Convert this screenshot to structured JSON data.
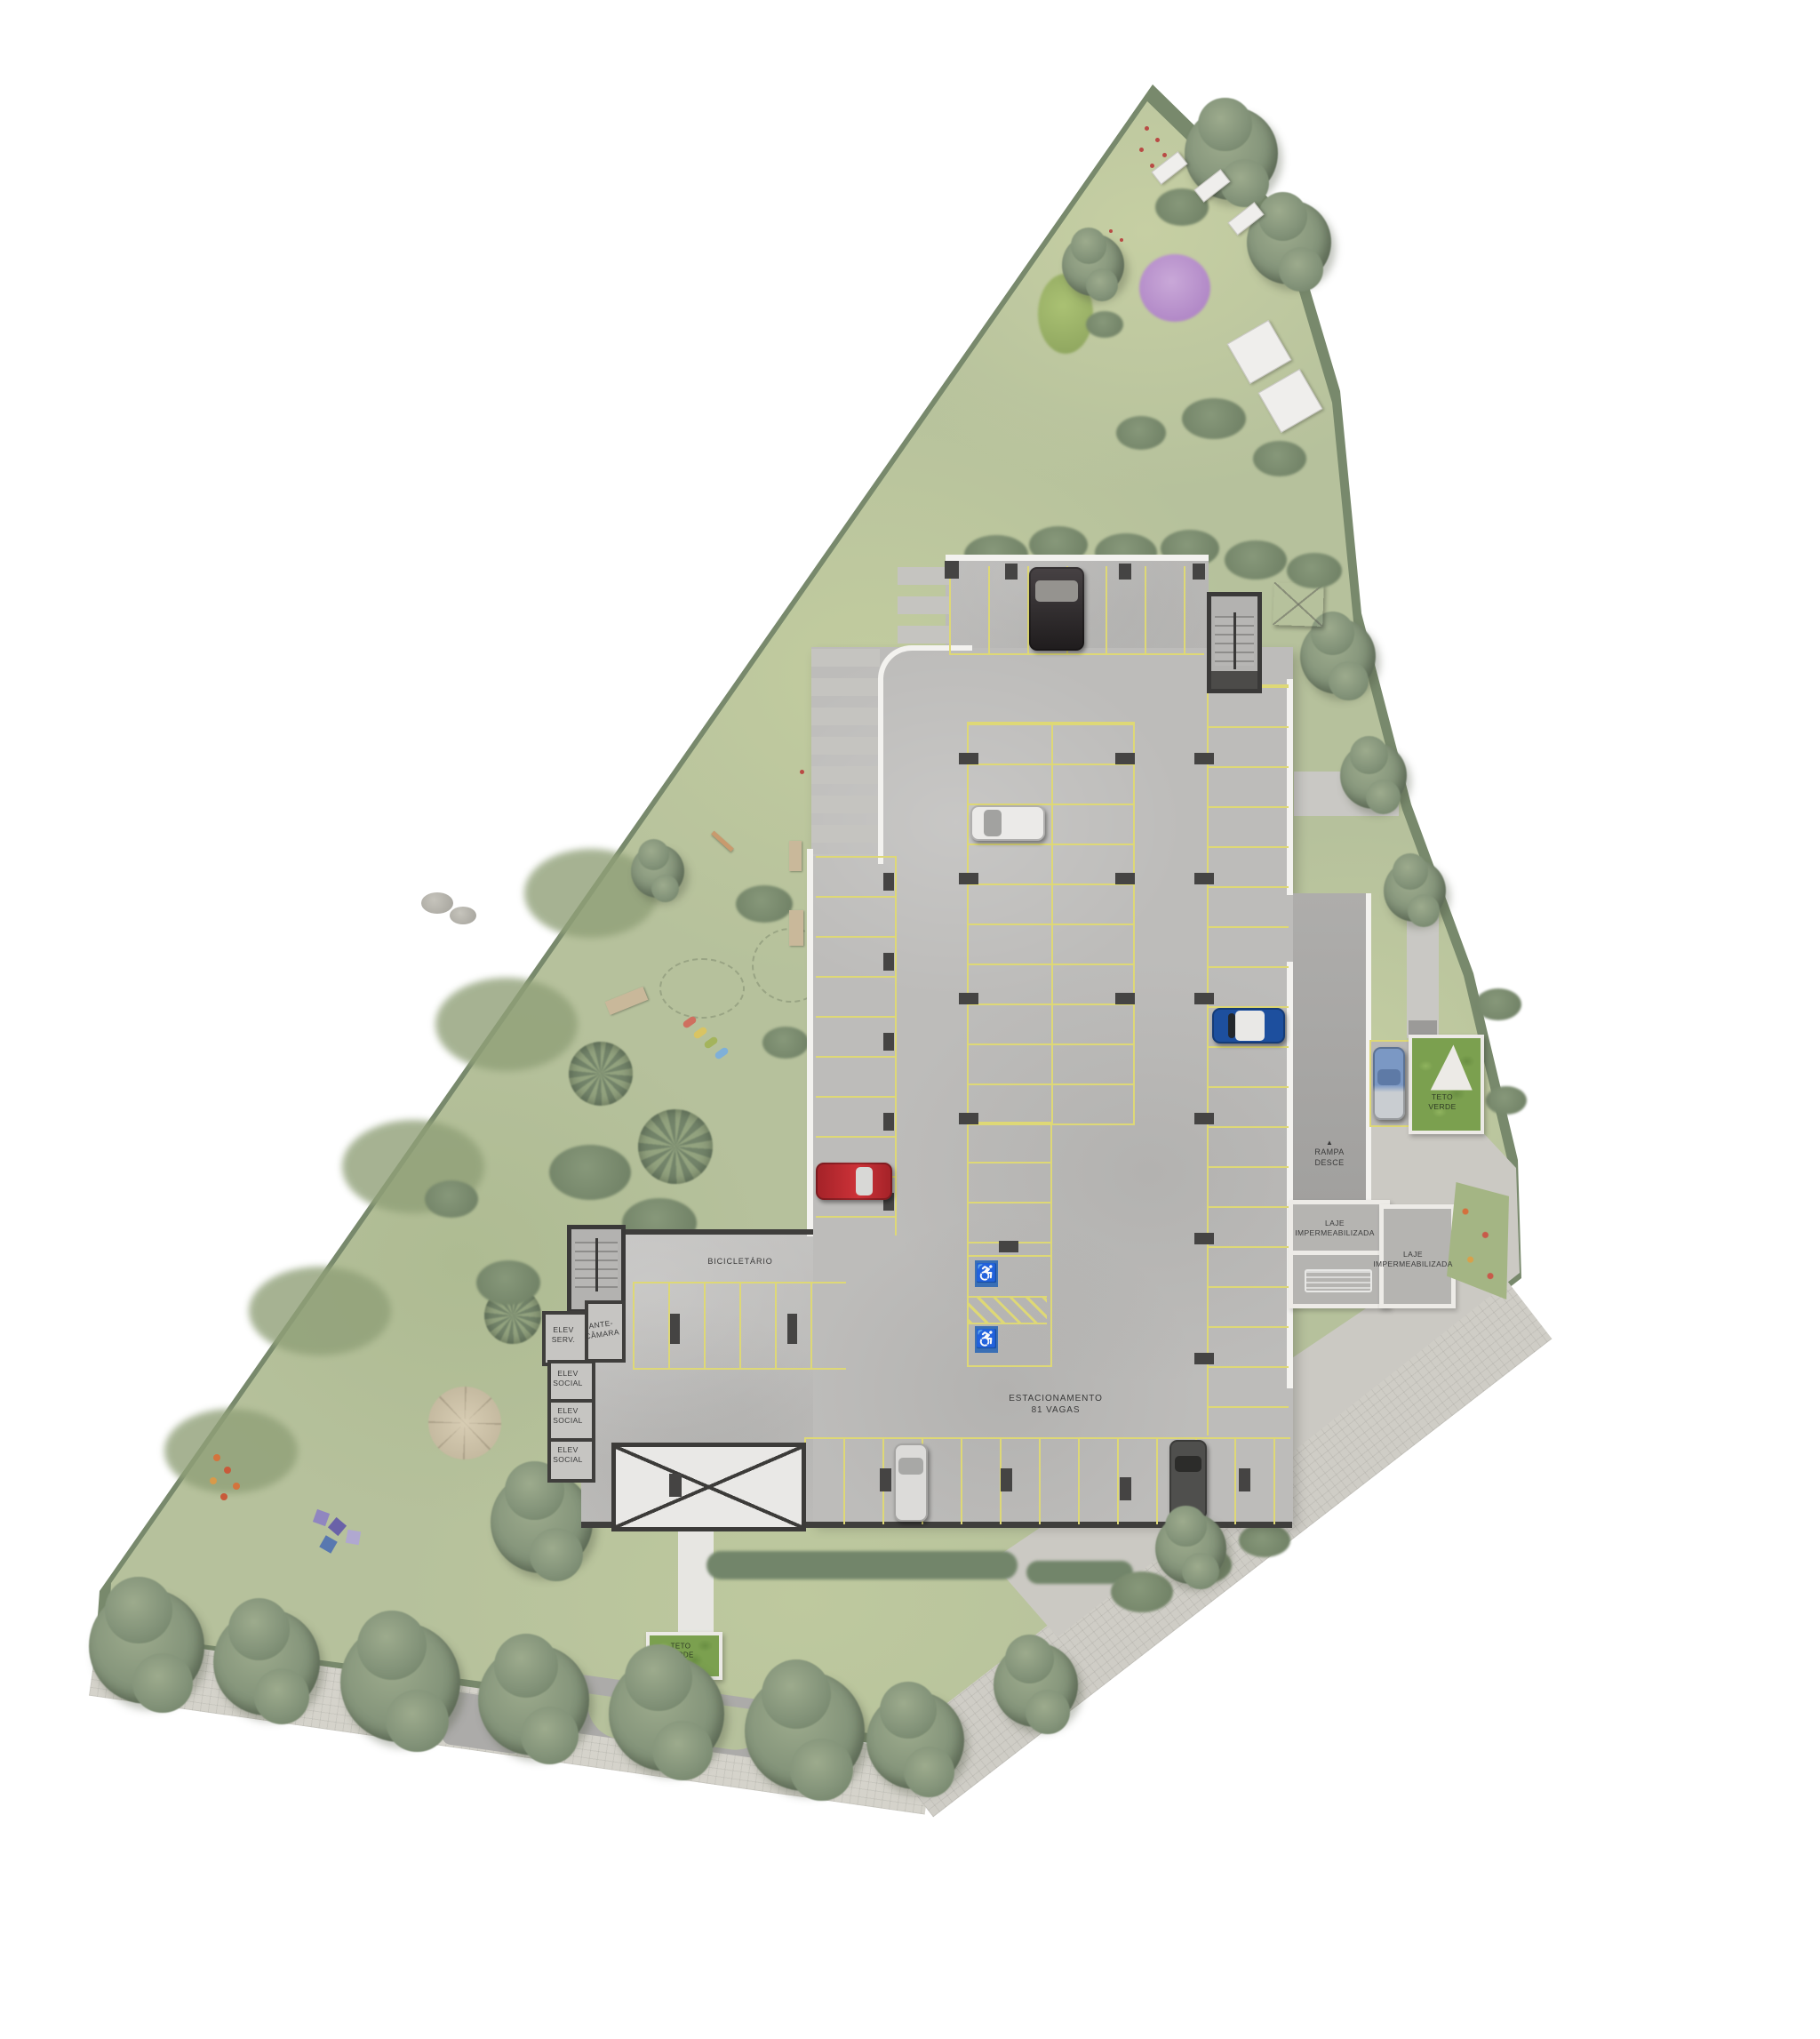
{
  "plan": {
    "parking": {
      "title_line1": "ESTACIONAMENTO",
      "title_line2": "81 VAGAS"
    },
    "rooms": {
      "bike": "BICICLETÁRIO",
      "elev_serv_l1": "ELEV",
      "elev_serv_l2": "SERV.",
      "ante_l1": "ANTE-",
      "ante_l2": "CÂMARA",
      "elev_social_l1": "ELEV",
      "elev_social_l2": "SOCIAL"
    },
    "ramp": {
      "arrow": "▲",
      "l1": "RAMPA",
      "l2": "DESCE"
    },
    "slabs": {
      "laje_l1": "LAJE",
      "laje_l2": "IMPERMEABILIZADA"
    },
    "green_roof": {
      "l1": "TETO",
      "l2": "VERDE"
    },
    "icons": {
      "accessible": "♿"
    }
  },
  "colors": {
    "grass": "#b6c19c",
    "hedge": "#78896c",
    "concrete": "#bdbcba",
    "concrete_dark": "#a8a7a5",
    "wall_dark": "#3f3e3c",
    "curb": "#f3f2ef",
    "yl": "#ded876",
    "hc_blue": "#3a6fb5",
    "label": "#3a3a3a",
    "groof": "#7ba04f",
    "pool1": "#b9d3e4",
    "pool2": "#8fb6d2",
    "walk": "#d5d3cb"
  }
}
